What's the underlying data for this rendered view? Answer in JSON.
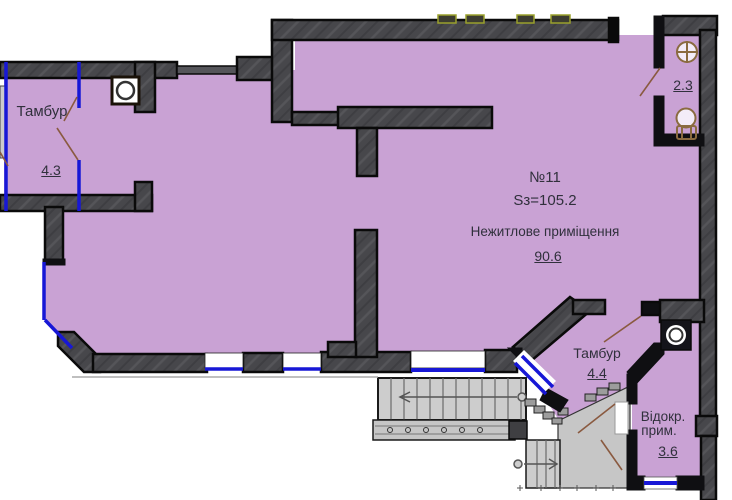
{
  "rooms": {
    "tambur_top": {
      "label": "Тамбур",
      "area": "4.3"
    },
    "main": {
      "number": "№11",
      "area_total": "Sз=105.2",
      "type": "Нежитлове приміщення",
      "area": "90.6"
    },
    "sanitary": {
      "area": "2.3"
    },
    "tambur_bottom": {
      "label": "Тамбур",
      "area": "4.4"
    },
    "detached": {
      "label_line1": "Відокр.",
      "label_line2": "прим.",
      "area": "3.6"
    }
  },
  "colors": {
    "room_fill": "#c9a2d4",
    "wall_fill": "#47474b",
    "wall_outline": "#0a0a0a",
    "window_blue": "#1717d6",
    "door_brown": "#8a5a40",
    "stairs_gray": "#cdcdcd",
    "vent_outline": "#9aa02c"
  },
  "icons": {
    "sink": "sink-icon",
    "toilet": "toilet-icon",
    "column": "column-icon",
    "shaft": "shaft-icon",
    "stair_arrow_up": "stairs-arrow-left",
    "stair_arrow_entry": "stairs-arrow-right"
  }
}
